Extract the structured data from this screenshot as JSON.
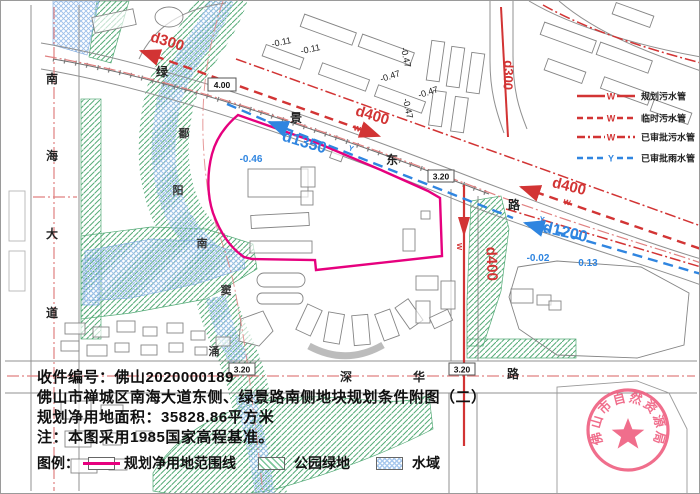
{
  "page": {
    "background": "#ffffff",
    "frame_color": "#9a9a9a"
  },
  "title_block": {
    "line1": "收件编号：佛山2020000189",
    "line2": "佛山市禅城区南海大道东侧、绿景路南侧地块规划条件附图（二）",
    "line3": "规划净用地面积：35828.86平方米",
    "line4": "注：本图采用1985国家高程基准。"
  },
  "map_legend": {
    "label": "图例：",
    "items": [
      {
        "name": "规划净用地范围线",
        "swatch": "boundary-line",
        "color": "#e6007e"
      },
      {
        "name": "公园绿地",
        "swatch": "park-hatch",
        "color": "#56ab78"
      },
      {
        "name": "水域",
        "swatch": "water-hatch",
        "color": "#9cc0ea"
      }
    ]
  },
  "pipe_legend": {
    "items": [
      {
        "symbol": "W",
        "label": "规划污水管",
        "color": "#d23434",
        "line": "solid"
      },
      {
        "symbol": "W",
        "label": "临时污水管",
        "color": "#d23434",
        "line": "dashed"
      },
      {
        "symbol": "W",
        "label": "已审批污水管",
        "color": "#d23434",
        "line": "dashdot"
      },
      {
        "symbol": "Y",
        "label": "已审批雨水管",
        "color": "#2f85e0",
        "line": "dashed"
      }
    ]
  },
  "roads": {
    "nanhai_dadao": {
      "name": "南海大道",
      "chars": [
        "南",
        "海",
        "大",
        "道"
      ]
    },
    "lvjing_donglu": {
      "name": "绿景东路",
      "chars": [
        "绿",
        "景",
        "东",
        "路"
      ]
    },
    "shenhua_lu": {
      "name": "深华路",
      "chars": [
        "深",
        "华",
        "路"
      ]
    }
  },
  "river": {
    "name": "鄱阳南窦涌",
    "chars": [
      "鄱",
      "阳",
      "南",
      "窦",
      "涌"
    ]
  },
  "pipes": {
    "labels": [
      {
        "text": "d300"
      },
      {
        "text": "d400"
      },
      {
        "text": "d400"
      },
      {
        "text": "d400"
      },
      {
        "text": "d300"
      },
      {
        "text": "d1350"
      },
      {
        "text": "d1200"
      }
    ],
    "flow_markers": {
      "sewer": "W",
      "storm": "Y"
    }
  },
  "elevations": {
    "black": [
      "-0.11",
      "-0.11",
      "-0.47",
      "-0.47",
      "-0.47",
      "-0.47"
    ],
    "blue": [
      "-0.46",
      "-0.02",
      "0.13"
    ],
    "boxed": [
      "4.00",
      "3.20",
      "3.20",
      "3.20"
    ]
  },
  "seal": {
    "text": "佛山市自然资源局",
    "color": "#ef5f80"
  }
}
